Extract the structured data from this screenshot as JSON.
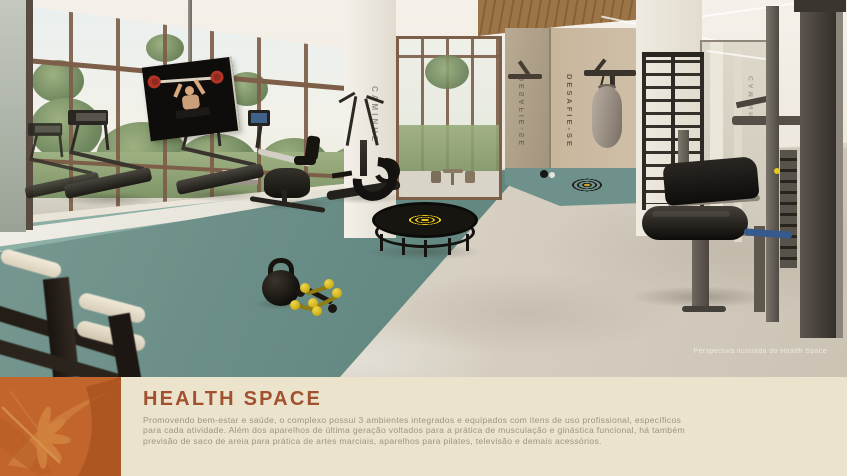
{
  "panel": {
    "title": "HEALTH SPACE",
    "body_lines": [
      "Promovendo bem-estar e saúde, o complexo possui 3 ambientes integrados e equipados com itens de uso profissional, específicos",
      "para cada atividade. Além dos aparelhos de última geração voltados para a prática de musculação e ginástica funcional, há também",
      "previsão de saco de areia para prática de artes marciais, aparelhos para pilates, televisão e demais acessórios."
    ]
  },
  "photo": {
    "caption": "Perspectiva ilustrada do Health Space",
    "wall_texts": {
      "pillar": "CAMINHE",
      "alcove": "DESAFIE-SE",
      "alcove_mirror": "DESAFIE-SE",
      "mirror_reflection": "CAMINHE"
    }
  },
  "colors": {
    "accent_orange": "#c2652c",
    "title_rust": "#a1512f",
    "panel_cream": "#ebe3cb",
    "mat_teal": "#6b8f88",
    "highlight_yellow": "#e8c81f",
    "frame_bronze": "#7c5e49"
  }
}
